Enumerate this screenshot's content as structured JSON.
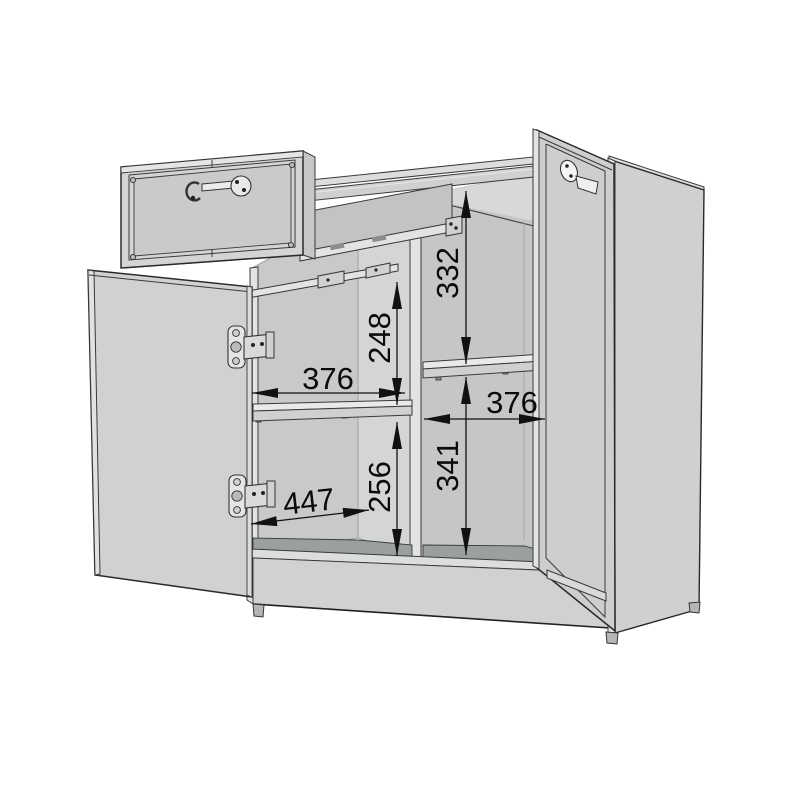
{
  "diagram": {
    "kind": "furniture-assembly-dimension-diagram",
    "subject": "two-door sideboard cabinet with open drawer, open left door and ajar right door",
    "dims": {
      "right_top_to_shelf": "332",
      "left_drawer_to_shelf": "248",
      "left_compartment_width": "376",
      "right_compartment_width": "376",
      "right_shelf_to_bottom": "341",
      "left_shelf_to_bottom": "256",
      "interior_depth": "447"
    },
    "colors": {
      "background": "#ffffff",
      "panel": "#d0d2d1",
      "interior_wall": "#c8cac9",
      "back_panel": "#d4d6d5",
      "floor": "#9aa09e",
      "shelf_top": "#e8eae9",
      "outline": "#3a3a3a",
      "dimension": "#111111"
    }
  }
}
